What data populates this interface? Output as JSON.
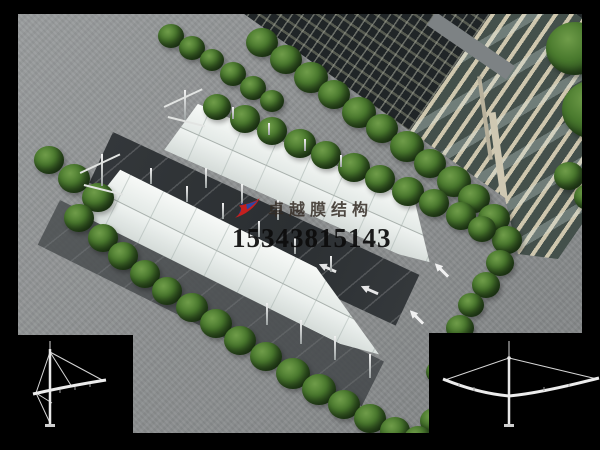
{
  "watermark": {
    "logo": "red-blue-swoosh-logo",
    "company": "卓越膜结构",
    "phone": "15343815143"
  },
  "insets": {
    "bottom_left": "single-cantilever-elevation-drawing",
    "bottom_right": "double-cantilever-elevation-drawing"
  },
  "colors": {
    "membrane": "#edf1ee",
    "asphalt": "#8e9192",
    "dark_lane": "#2e3235",
    "tree_green": "#3f6b2a",
    "building_facade": "#23282a",
    "tower_beige": "#cfc7ae",
    "logo_red": "#c4201f",
    "logo_blue": "#20388f",
    "panel_background": "#000000",
    "drawing_stroke": "#d6d6d6"
  }
}
